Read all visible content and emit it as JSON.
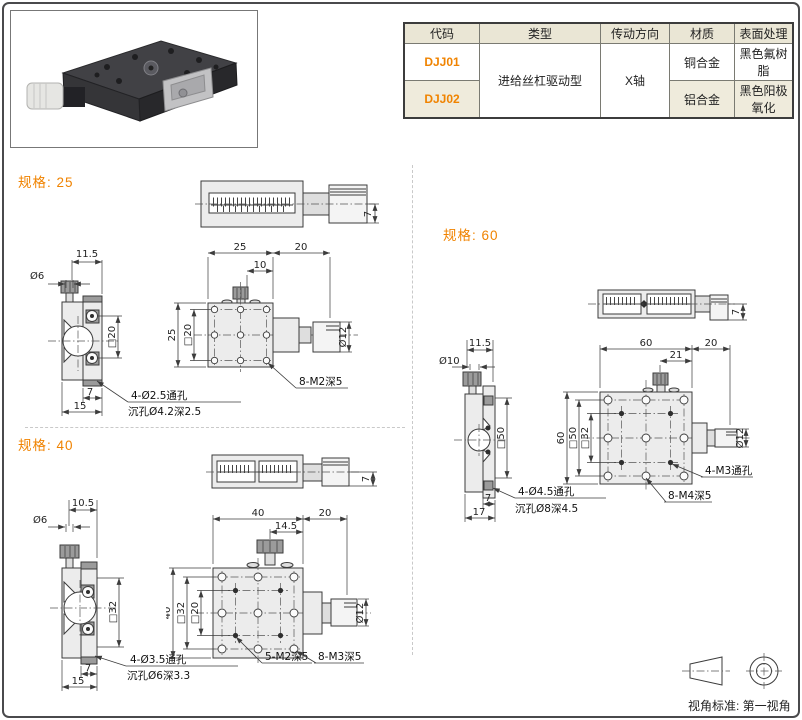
{
  "colors": {
    "accent": "#F08300",
    "table_header_bg": "#EAE6D5",
    "table_alt_row_bg": "#EFEBDC"
  },
  "table": {
    "headers": [
      "代码",
      "类型",
      "传动方向",
      "材质",
      "表面处理"
    ],
    "type_value": "进给丝杠驱动型",
    "direction_value": "X轴",
    "rows": [
      {
        "code": "DJJ01",
        "material": "铜合金",
        "surface": "黑色氟树脂"
      },
      {
        "code": "DJJ02",
        "material": "铝合金",
        "surface": "黑色阳极氧化"
      }
    ]
  },
  "sections": {
    "s25": {
      "label": "规格: 25",
      "top": {
        "h": "7"
      },
      "side": {
        "w": "11.5",
        "knob_d": "Ø6",
        "sq": "□20",
        "off": "7",
        "base": "15",
        "note1": "4-Ø2.5通孔",
        "note2": "沉孔Ø4.2深2.5"
      },
      "front": {
        "w": "25",
        "knob_len": "20",
        "off": "10",
        "h": "25",
        "sq": "□20",
        "mic_d": "Ø12",
        "note1": "8-M2深5"
      }
    },
    "s40": {
      "label": "规格: 40",
      "top": {
        "h": "7"
      },
      "side": {
        "w": "10.5",
        "knob_d": "Ø6",
        "sq": "□32",
        "off": "7",
        "base": "15",
        "note1": "4-Ø3.5通孔",
        "note2": "沉孔Ø6深3.3"
      },
      "front": {
        "w": "40",
        "knob_len": "20",
        "off": "14.5",
        "h": "40",
        "sq1": "□32",
        "sq2": "□20",
        "mic_d": "Ø12",
        "note1": "5-M2深5",
        "note2": "8-M3深5"
      }
    },
    "s60": {
      "label": "规格: 60",
      "top": {
        "h": "7"
      },
      "side": {
        "w": "11.5",
        "knob_d": "Ø10",
        "sq": "□50",
        "off": "7",
        "base": "17",
        "note1": "4-Ø4.5通孔",
        "note2": "沉孔Ø8深4.5"
      },
      "front": {
        "w": "60",
        "knob_len": "20",
        "off": "21",
        "h": "60",
        "sq1": "□50",
        "sq2": "□32",
        "mic_d": "Ø12",
        "note1": "4-M3通孔",
        "note2": "8-M4深5"
      }
    }
  },
  "footer": {
    "label": "视角标准: 第一视角"
  }
}
